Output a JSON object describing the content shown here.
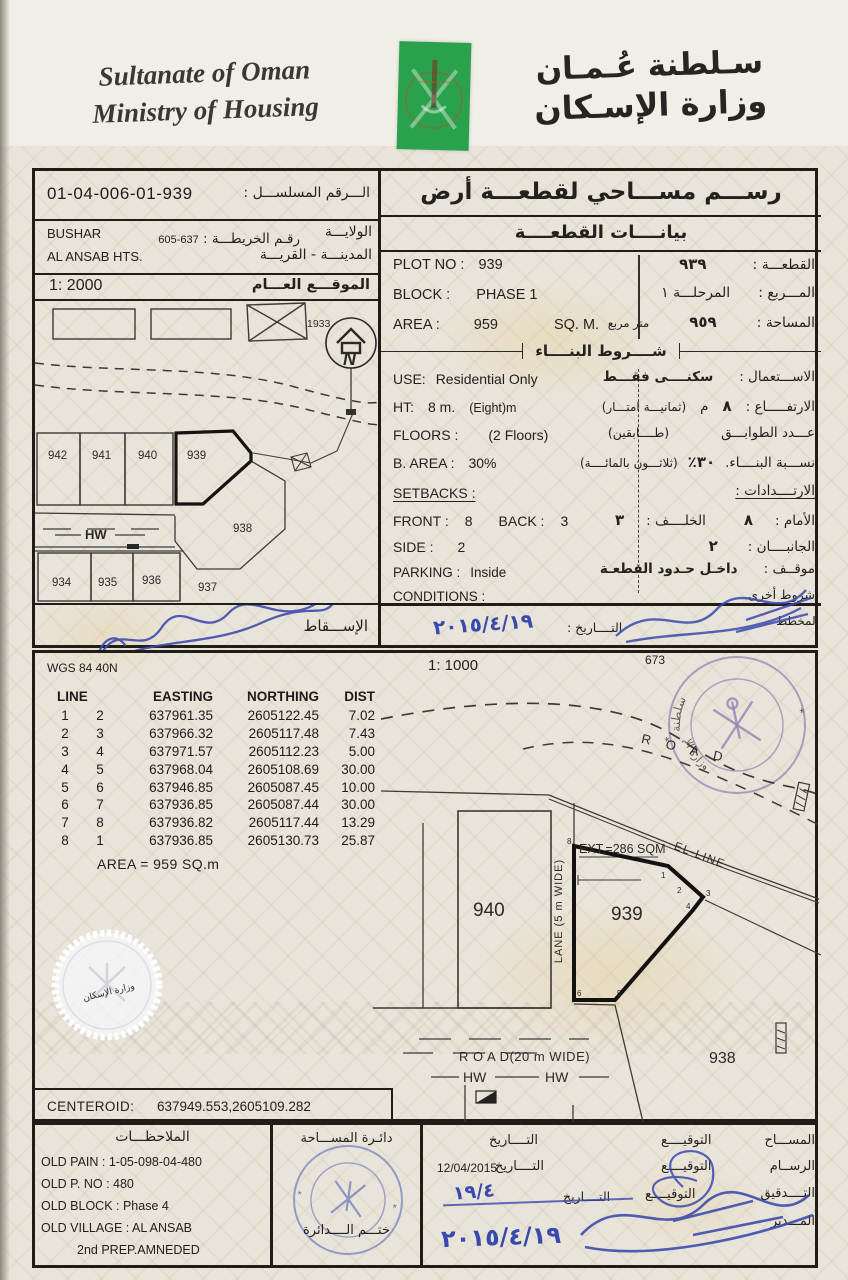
{
  "header": {
    "en1": "Sultanate of Oman",
    "en2": "Ministry of Housing",
    "ar1": "سـلطنة عُـمـان",
    "ar2": "وزارة الإسـكان"
  },
  "serial": {
    "label_ar": "الـــرقم المسلســـل :",
    "value": "01-04-006-01-939"
  },
  "region": {
    "wilaya_en": "BUSHAR",
    "city_en": "AL ANSAB HTS.",
    "map_label_ar": "رقـم الخريطـــة :",
    "map_no": "637-605",
    "wilaya_label_ar": "الولايـــة",
    "city_label_ar": "المدينـــة - القريـــة"
  },
  "locmap": {
    "scale": "1: 2000",
    "title_ar": "الموقـــع العـــام",
    "ref": "1933",
    "north": "N",
    "hw": "HW",
    "r1": [
      "942",
      "941",
      "940",
      "939"
    ],
    "p938": "938",
    "r2": [
      "934",
      "935",
      "936",
      "937"
    ],
    "esc_ar": "الإســـقاط"
  },
  "title": {
    "main_ar": "رســـم مســـاحي لقطعـــة أرض",
    "sub_ar": "بيانــــات القطعــــة"
  },
  "info": {
    "plot_l": "PLOT NO :",
    "plot_v": "939",
    "plot_ar_v": "٩٣٩",
    "plot_ar_l": "القطعـــة :",
    "block_l": "BLOCK :",
    "block_v": "PHASE 1",
    "block_ar_v": "المرحلـــة ١",
    "block_ar_l": "المـــربع :",
    "area_l": "AREA :",
    "area_v": "959",
    "area_u": "SQ. M.",
    "area_ar_u": "متر مربع",
    "area_ar_v": "٩٥٩",
    "area_ar_l": "المساحة :"
  },
  "cond": {
    "title_ar": "شــــروط البنــــاء",
    "use_l": "USE:",
    "use_v": "Residential Only",
    "use_ar_l": "الاســـتعمال :",
    "use_ar_v": "سكنــــى فقـــط",
    "ht_l": "HT:",
    "ht_v": "8 m.",
    "ht_n": "(Eight)m",
    "ht_ar_l": "الارتفـــــاع :",
    "ht_ar_v": "٨",
    "ht_ar_u": "م",
    "ht_ar_n": "(ثمانيـــة امتـــار)",
    "fl_l": "FLOORS :",
    "fl_v": "(2 Floors)",
    "fl_ar_l": "عـــدد الطوابـــق",
    "fl_ar_v": "(طــــابقين)",
    "ba_l": "B. AREA :",
    "ba_v": "30%",
    "ba_ar_l": "نســـبة البنــــاء.",
    "ba_ar_v": "٣٠٪",
    "ba_ar_n": "(ثلاثـــون بالمائــــة)",
    "sb_l": "SETBACKS :",
    "sb_ar_l": "الارتــــدادات :",
    "fr_l": "FRONT :",
    "fr_v": "8",
    "bk_l": "BACK :",
    "bk_v": "3",
    "fr_ar_l": "الأمام :",
    "fr_ar_v": "٨",
    "bk_ar_l": "الخلــــف :",
    "bk_ar_v": "٣",
    "sd_l": "SIDE :",
    "sd_v": "2",
    "sd_ar_l": "الجانبــــان :",
    "sd_ar_v": "٢",
    "pk_l": "PARKING :",
    "pk_v": "Inside",
    "pk_ar_l": "موقــف :",
    "pk_ar_v": "داخـل حـدود القطعـة",
    "cd_l": "CONDITIONS :",
    "cd_ar_l": "شروط أخرى"
  },
  "topsig": {
    "planner_ar": "المخطط",
    "date_l_ar": "التــــاريخ :",
    "date_hand": "٢٠١٥/٤/١٩"
  },
  "survey": {
    "datum": "WGS 84 40N",
    "scale": "1: 1000",
    "sheet": "673",
    "h": [
      "LINE",
      "EASTING",
      "NORTHING",
      "DIST"
    ],
    "rows": [
      [
        "1",
        "2",
        "637961.35",
        "2605122.45",
        "7.02"
      ],
      [
        "2",
        "3",
        "637966.32",
        "2605117.48",
        "7.43"
      ],
      [
        "3",
        "4",
        "637971.57",
        "2605112.23",
        "5.00"
      ],
      [
        "4",
        "5",
        "637968.04",
        "2605108.69",
        "30.00"
      ],
      [
        "5",
        "6",
        "637946.85",
        "2605087.45",
        "10.00"
      ],
      [
        "6",
        "7",
        "637936.85",
        "2605087.44",
        "30.00"
      ],
      [
        "7",
        "8",
        "637936.82",
        "2605117.44",
        "13.29"
      ],
      [
        "8",
        "1",
        "637936.85",
        "2605130.73",
        "25.87"
      ]
    ],
    "area_line": "AREA = 959  SQ.m",
    "cent_l": "CENTEROID:",
    "cent_v": "637949.553,2605109.282"
  },
  "draw": {
    "road": "R O A D",
    "ext": "EXT.=286 SQM",
    "el": "EL-LINE",
    "p939": "939",
    "p940": "940",
    "p938": "938",
    "lane": "LANE (5 m WIDE)",
    "road20": "R O A D(20 m WIDE)",
    "hw": "HW",
    "verts": [
      "1",
      "2",
      "3",
      "4",
      "5",
      "6",
      "8"
    ]
  },
  "notes": {
    "title_ar": "الملاحظـــات",
    "lines": [
      "OLD PAIN : 1-05-098-04-480",
      "OLD P. NO : 480",
      "OLD BLOCK : Phase 4",
      "OLD VILLAGE : AL ANSAB",
      "2nd PREP.AMNEDED"
    ]
  },
  "dept": {
    "l1_ar": "دائـرة المســـاحة",
    "l2_ar": "ختـــم الــــدائرة"
  },
  "approve": {
    "roles": [
      "المســـاح",
      "الرســام",
      "التــــدقيق",
      "المـــدير"
    ],
    "sig_l_ar": "التوقيــــع",
    "date_l_ar": "التــــاريخ",
    "date2": "12/04/2015",
    "hand3": "١٩/٤",
    "hand4": "٢٠١٥/٤/١٩"
  }
}
